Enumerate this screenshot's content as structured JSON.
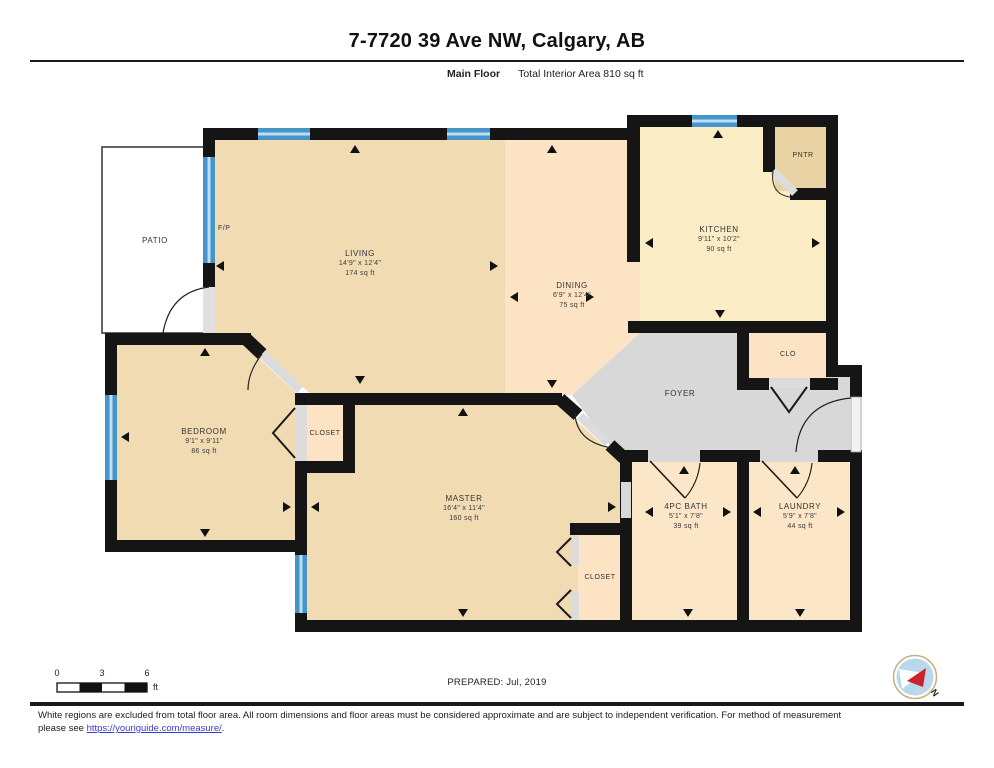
{
  "page": {
    "title": "7-7720 39 Ave NW, Calgary, AB",
    "floor_label": "Main Floor",
    "area_label": "Total Interior Area 810 sq ft"
  },
  "rooms": {
    "patio": {
      "name": "PATIO"
    },
    "fireplace": {
      "name": "F/P"
    },
    "living": {
      "name": "LIVING",
      "dims": "14'9\" x 12'4\"",
      "area": "174 sq ft"
    },
    "dining": {
      "name": "DINING",
      "dims": "6'9\" x 12'4\"",
      "area": "75 sq ft"
    },
    "kitchen": {
      "name": "KITCHEN",
      "dims": "9'11\" x 10'2\"",
      "area": "90 sq ft"
    },
    "pantry": {
      "name": "PNTR"
    },
    "clo": {
      "name": "CLO"
    },
    "foyer": {
      "name": "FOYER"
    },
    "bedroom": {
      "name": "BEDROOM",
      "dims": "9'1\" x 9'11\"",
      "area": "86 sq ft"
    },
    "bedroom_closet": {
      "name": "CLOSET"
    },
    "master": {
      "name": "MASTER",
      "dims": "16'4\" x 11'4\"",
      "area": "160 sq ft"
    },
    "master_closet": {
      "name": "CLOSET"
    },
    "bath": {
      "name": "4PC BATH",
      "dims": "5'1\" x 7'8\"",
      "area": "39 sq ft"
    },
    "laundry": {
      "name": "LAUNDRY",
      "dims": "5'9\" x 7'8\"",
      "area": "44 sq ft"
    }
  },
  "scale_bar": {
    "start": "0",
    "mid": "3",
    "end": "6",
    "unit": "ft"
  },
  "prepared_label": "PREPARED: Jul, 2019",
  "compass": {
    "north_label": "N"
  },
  "footer": {
    "line1": "White regions are excluded from total floor area. All room dimensions and floor areas must be considered approximate and are subject to independent verification. For method of measurement",
    "line2_prefix": "please see ",
    "link": "https://youriguide.com/measure/",
    "line2_suffix": "."
  },
  "colors": {
    "wall": "#151515",
    "window": "#4695c8",
    "room_tan": "#f1dbb3",
    "room_peach": "#fbe3c3",
    "room_kitchen": "#faecc4",
    "room_pantry": "#e9d2a4",
    "foyer_gray": "#d8d8d8",
    "link_blue": "#3b3bd0"
  }
}
